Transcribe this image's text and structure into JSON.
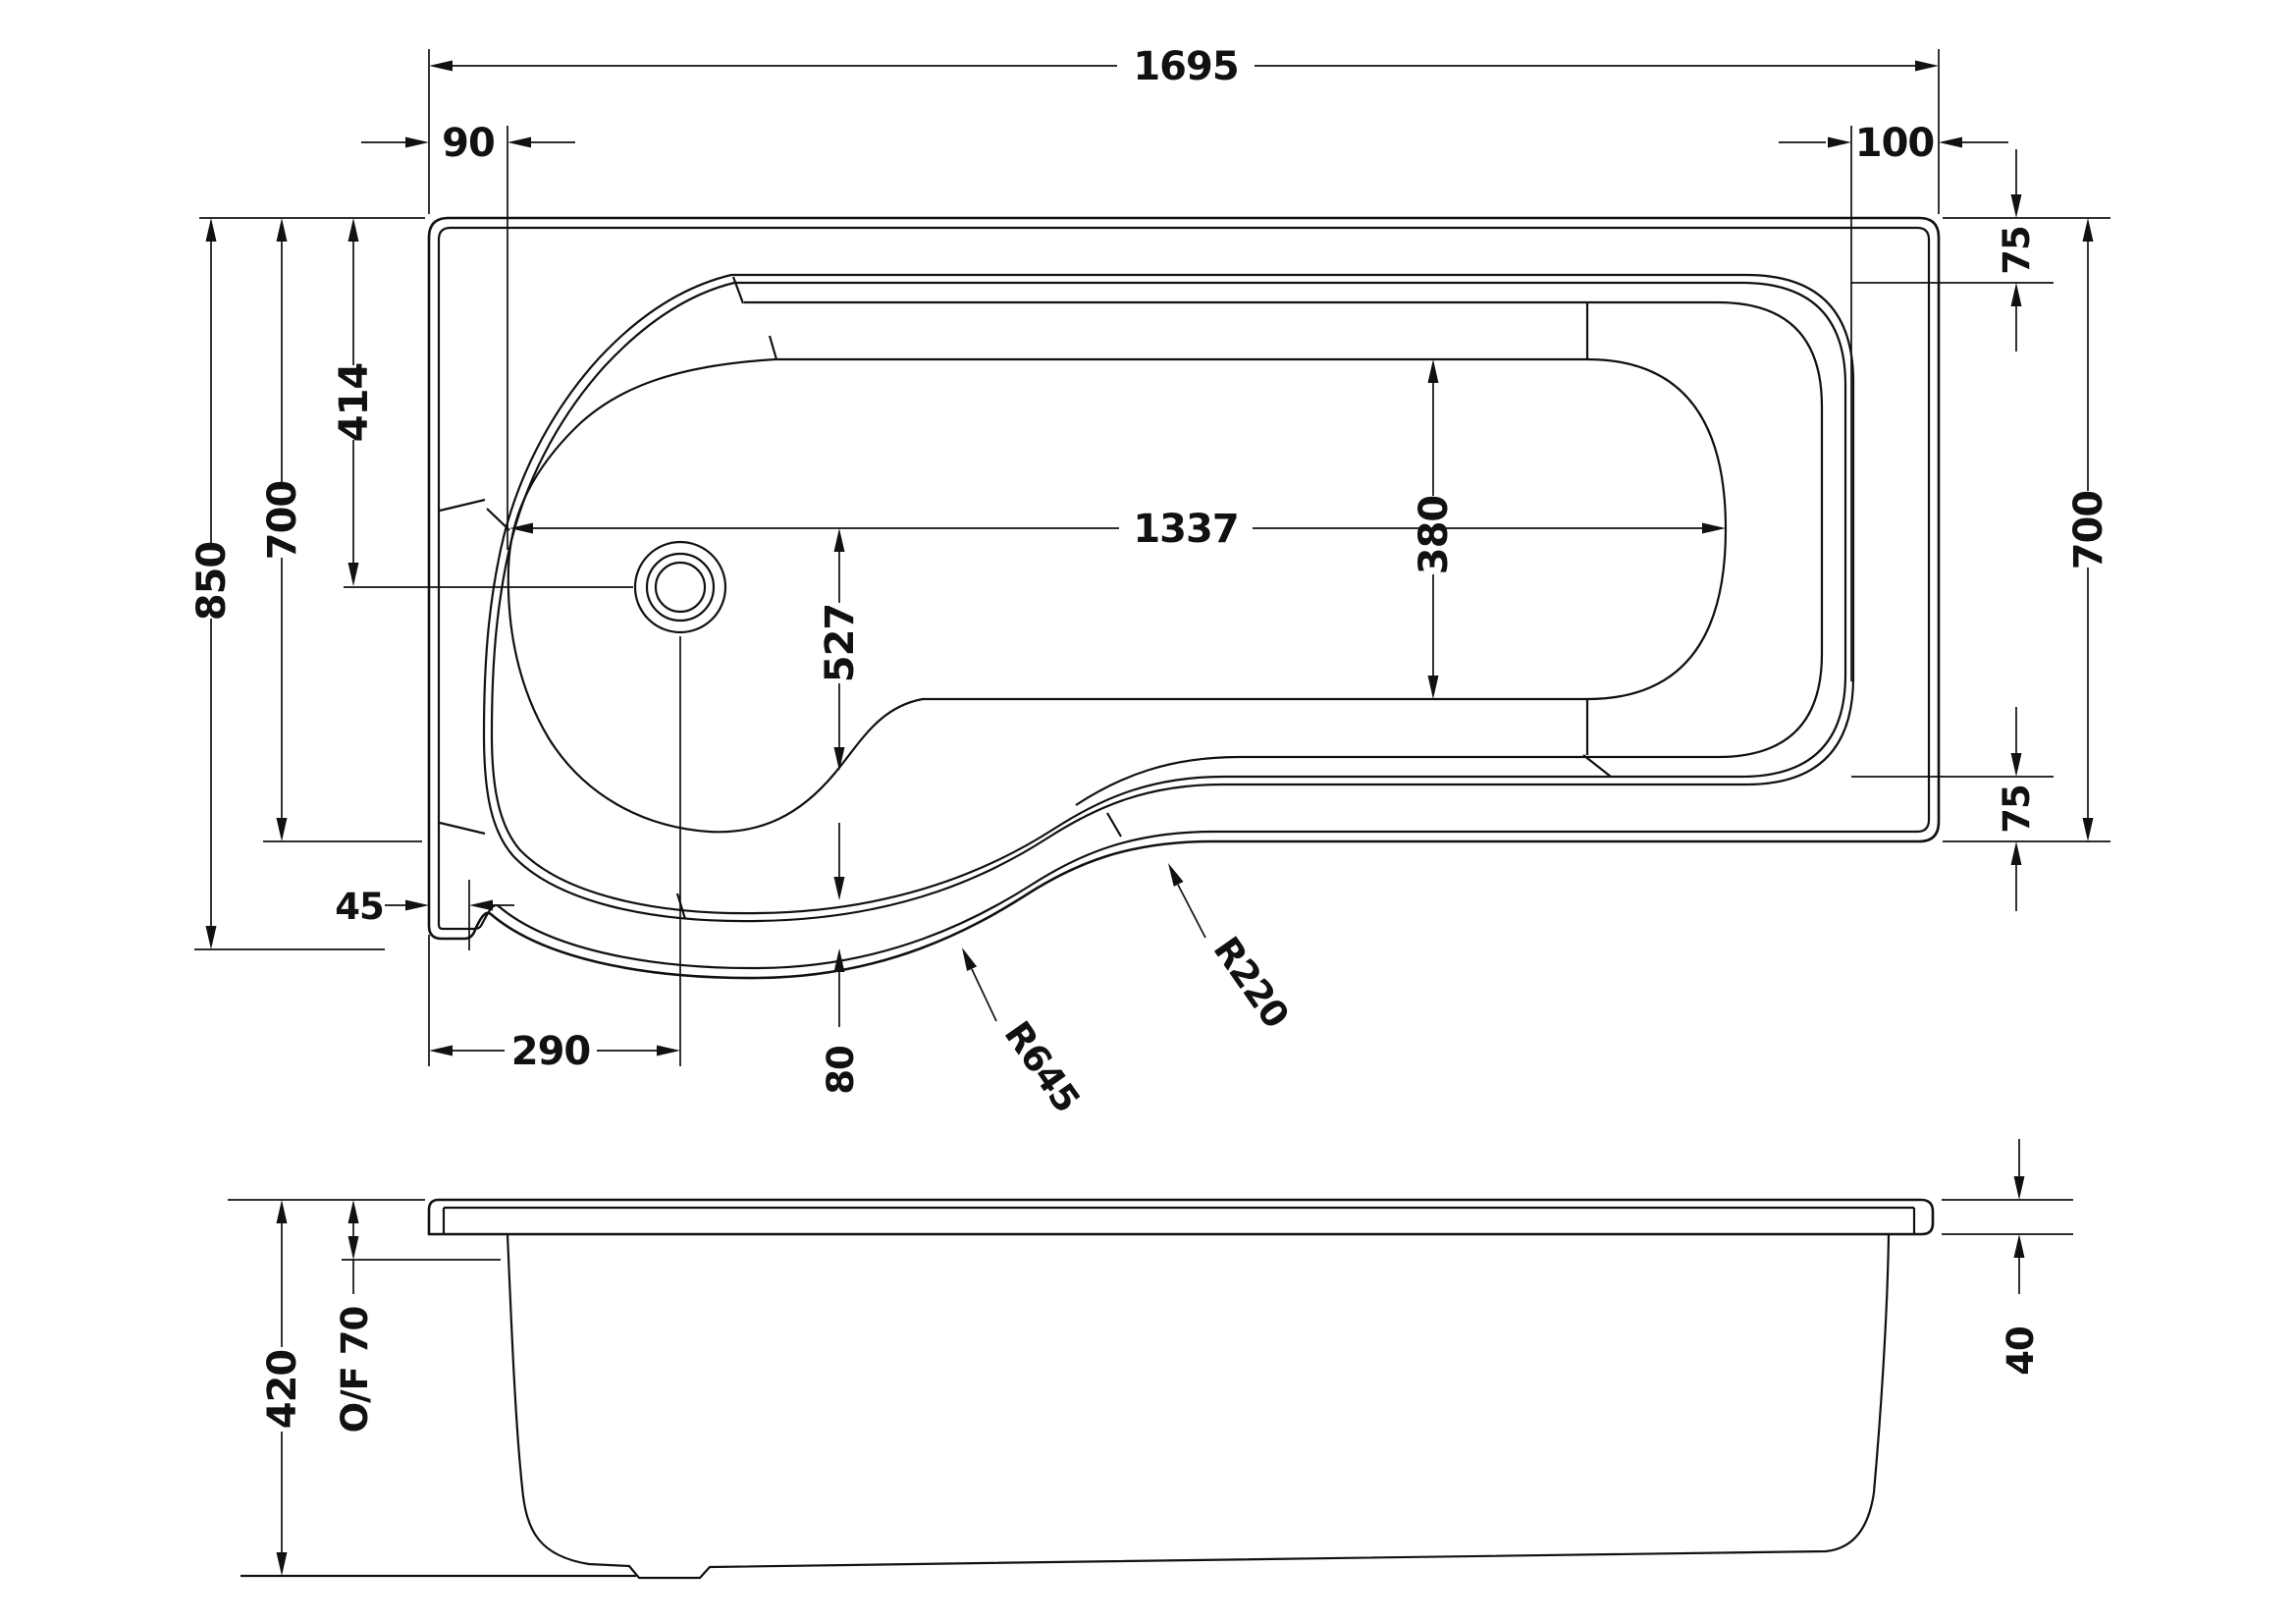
{
  "drawing": {
    "title": "P-shaped shower bath technical drawing",
    "top_view": {
      "overall_length": "1695",
      "left_offset": "90",
      "right_offset": "100",
      "rim_top_right": "75",
      "side_height_right": "700",
      "rim_bottom_right": "75",
      "overall_width": "850",
      "side_height_left": "700",
      "drain_depth": "414",
      "step": "45",
      "drain_offset": "290",
      "bowl_length": "1337",
      "bowl_depth": "527",
      "bowl_width": "380",
      "ledge_gap": "80",
      "radius_large": "R645",
      "radius_small": "R220"
    },
    "side_view": {
      "overall_height": "420",
      "overflow": "O/F 70",
      "rim_thickness": "40"
    },
    "colors": {
      "line": "#111111",
      "background": "#ffffff"
    }
  }
}
